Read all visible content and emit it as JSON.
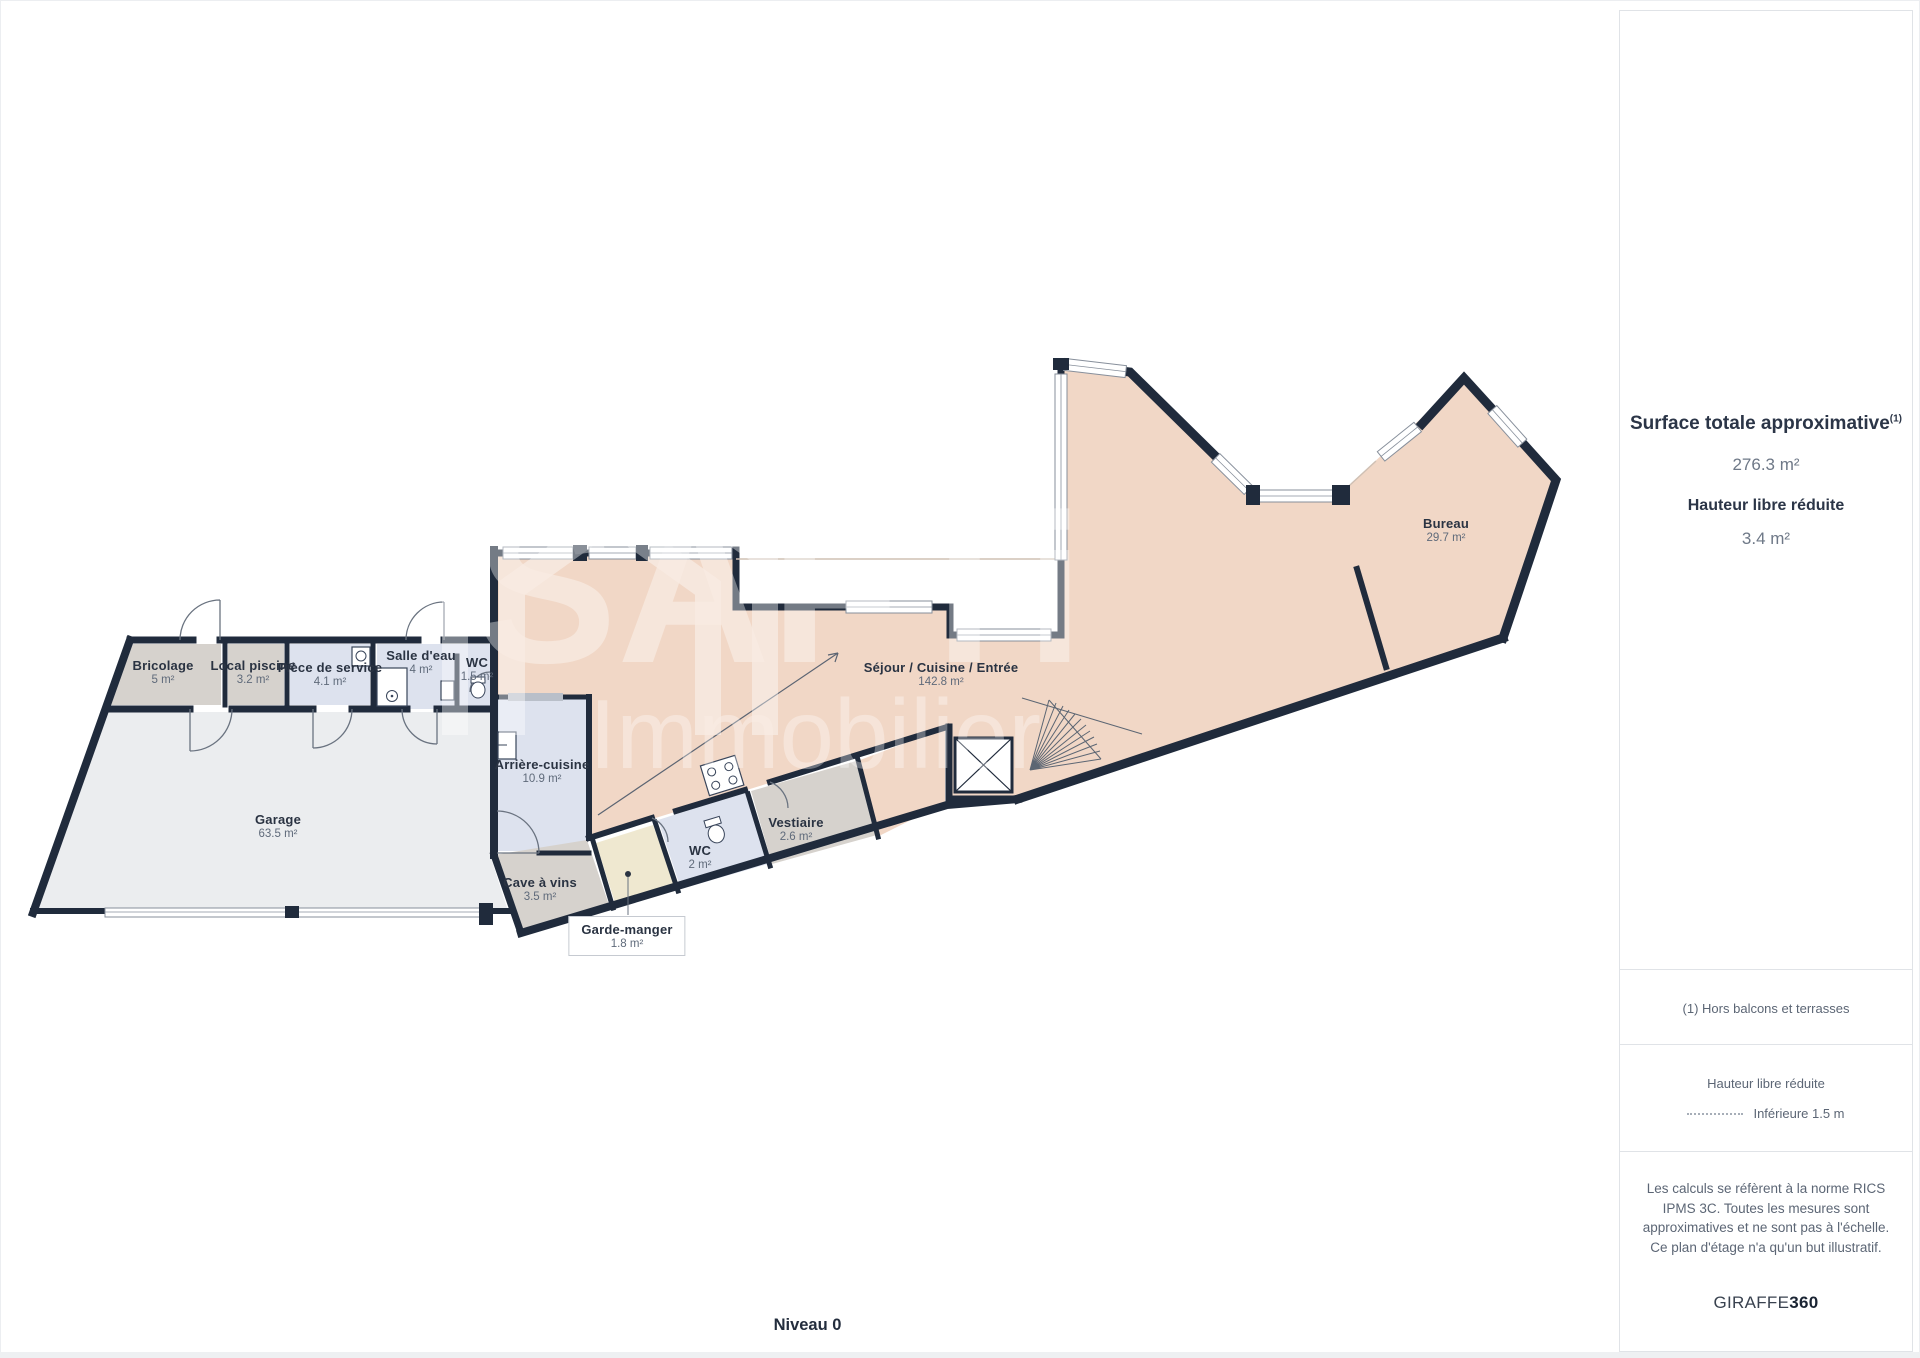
{
  "floorplan": {
    "level_label": "Niveau 0",
    "watermark": {
      "line1": "SAFTi",
      "line2": "Immobilier"
    },
    "rooms": [
      {
        "id": "bricolage",
        "name": "Bricolage",
        "area": "5 m²"
      },
      {
        "id": "local-piscine",
        "name": "Local piscine",
        "area": "3.2 m²"
      },
      {
        "id": "piece-de-service",
        "name": "Pièce de service",
        "area": "4.1 m²"
      },
      {
        "id": "salle-deau",
        "name": "Salle d'eau",
        "area": "4 m²"
      },
      {
        "id": "wc-small",
        "name": "WC",
        "area": "1.5 m²"
      },
      {
        "id": "garage",
        "name": "Garage",
        "area": "63.5 m²"
      },
      {
        "id": "arriere-cuisine",
        "name": "Arrière-cuisine",
        "area": "10.9 m²"
      },
      {
        "id": "cave-a-vins",
        "name": "Cave à vins",
        "area": "3.5 m²"
      },
      {
        "id": "garde-manger",
        "name": "Garde-manger",
        "area": "1.8 m²"
      },
      {
        "id": "wc",
        "name": "WC",
        "area": "2 m²"
      },
      {
        "id": "vestiaire",
        "name": "Vestiaire",
        "area": "2.6 m²"
      },
      {
        "id": "sejour",
        "name": "Séjour / Cuisine / Entrée",
        "area": "142.8 m²"
      },
      {
        "id": "bureau",
        "name": "Bureau",
        "area": "29.7 m²"
      }
    ]
  },
  "sidebar": {
    "title": "Surface totale approximative",
    "title_superscript": "(1)",
    "total_area": "276.3 m²",
    "subtitle": "Hauteur libre réduite",
    "reduced_area": "3.4 m²",
    "footnote": "(1) Hors balcons et terrasses",
    "legend_title": "Hauteur libre réduite",
    "legend_item": "Inférieure 1.5 m",
    "disclaimer": "Les calculs se réfèrent à la norme RICS IPMS 3C. Toutes les mesures sont approximatives et ne sont pas à l'échelle. Ce plan d'étage n'a qu'un but illustratif.",
    "brand_name": "GIRAFFE",
    "brand_suffix": "360"
  },
  "colors": {
    "wall": "#202b3c",
    "pink": "#f1d7c6",
    "blue": "#dde2ee",
    "gray": "#d6d2cd",
    "garage": "#ebedef",
    "pantry": "#efe8d0"
  }
}
